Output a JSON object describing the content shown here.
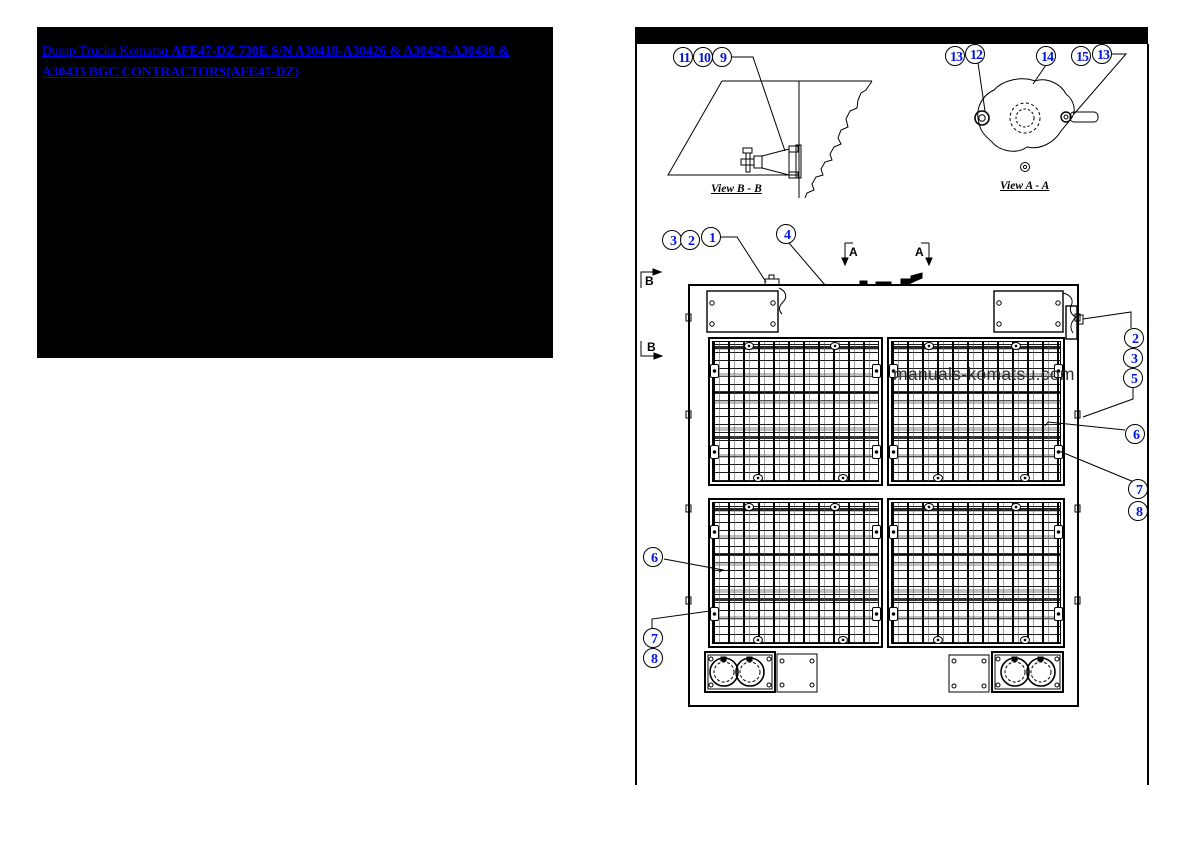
{
  "colors": {
    "link_blue": "#0000ee",
    "callout_blue": "#0016e0",
    "drawing_black": "#000000",
    "panel_black": "#000000",
    "watermark_gray": "#2e2e2e"
  },
  "breadcrumb": {
    "prefix": "Dump Trucks Komatsu ",
    "link": "AFE47-DZ 730E S/N A30418-A30426 & A30429-A30430 & A30433 BGC CONTRACTORS(AFE47-DZ)"
  },
  "watermark": "manuals-komatsu.com",
  "views": {
    "view_bb_label": "View B - B",
    "view_aa_label": "View A - A"
  },
  "section_marks": {
    "a_left": "A",
    "a_right": "A",
    "b_top": "B",
    "b_bottom": "B"
  },
  "callouts": [
    {
      "n": "11",
      "x": 683,
      "y": 57
    },
    {
      "n": "10",
      "x": 703,
      "y": 57
    },
    {
      "n": "9",
      "x": 722,
      "y": 57
    },
    {
      "n": "13",
      "x": 955,
      "y": 56
    },
    {
      "n": "12",
      "x": 975,
      "y": 54
    },
    {
      "n": "14",
      "x": 1046,
      "y": 56
    },
    {
      "n": "15",
      "x": 1081,
      "y": 56
    },
    {
      "n": "13",
      "x": 1102,
      "y": 54
    },
    {
      "n": "3",
      "x": 672,
      "y": 240
    },
    {
      "n": "2",
      "x": 690,
      "y": 240
    },
    {
      "n": "1",
      "x": 711,
      "y": 237
    },
    {
      "n": "4",
      "x": 786,
      "y": 234
    },
    {
      "n": "2",
      "x": 1134,
      "y": 338
    },
    {
      "n": "3",
      "x": 1133,
      "y": 358
    },
    {
      "n": "5",
      "x": 1133,
      "y": 378
    },
    {
      "n": "6",
      "x": 1135,
      "y": 434
    },
    {
      "n": "7",
      "x": 1138,
      "y": 489
    },
    {
      "n": "8",
      "x": 1138,
      "y": 511
    },
    {
      "n": "6",
      "x": 653,
      "y": 557
    },
    {
      "n": "7",
      "x": 653,
      "y": 638
    },
    {
      "n": "8",
      "x": 653,
      "y": 658
    }
  ]
}
